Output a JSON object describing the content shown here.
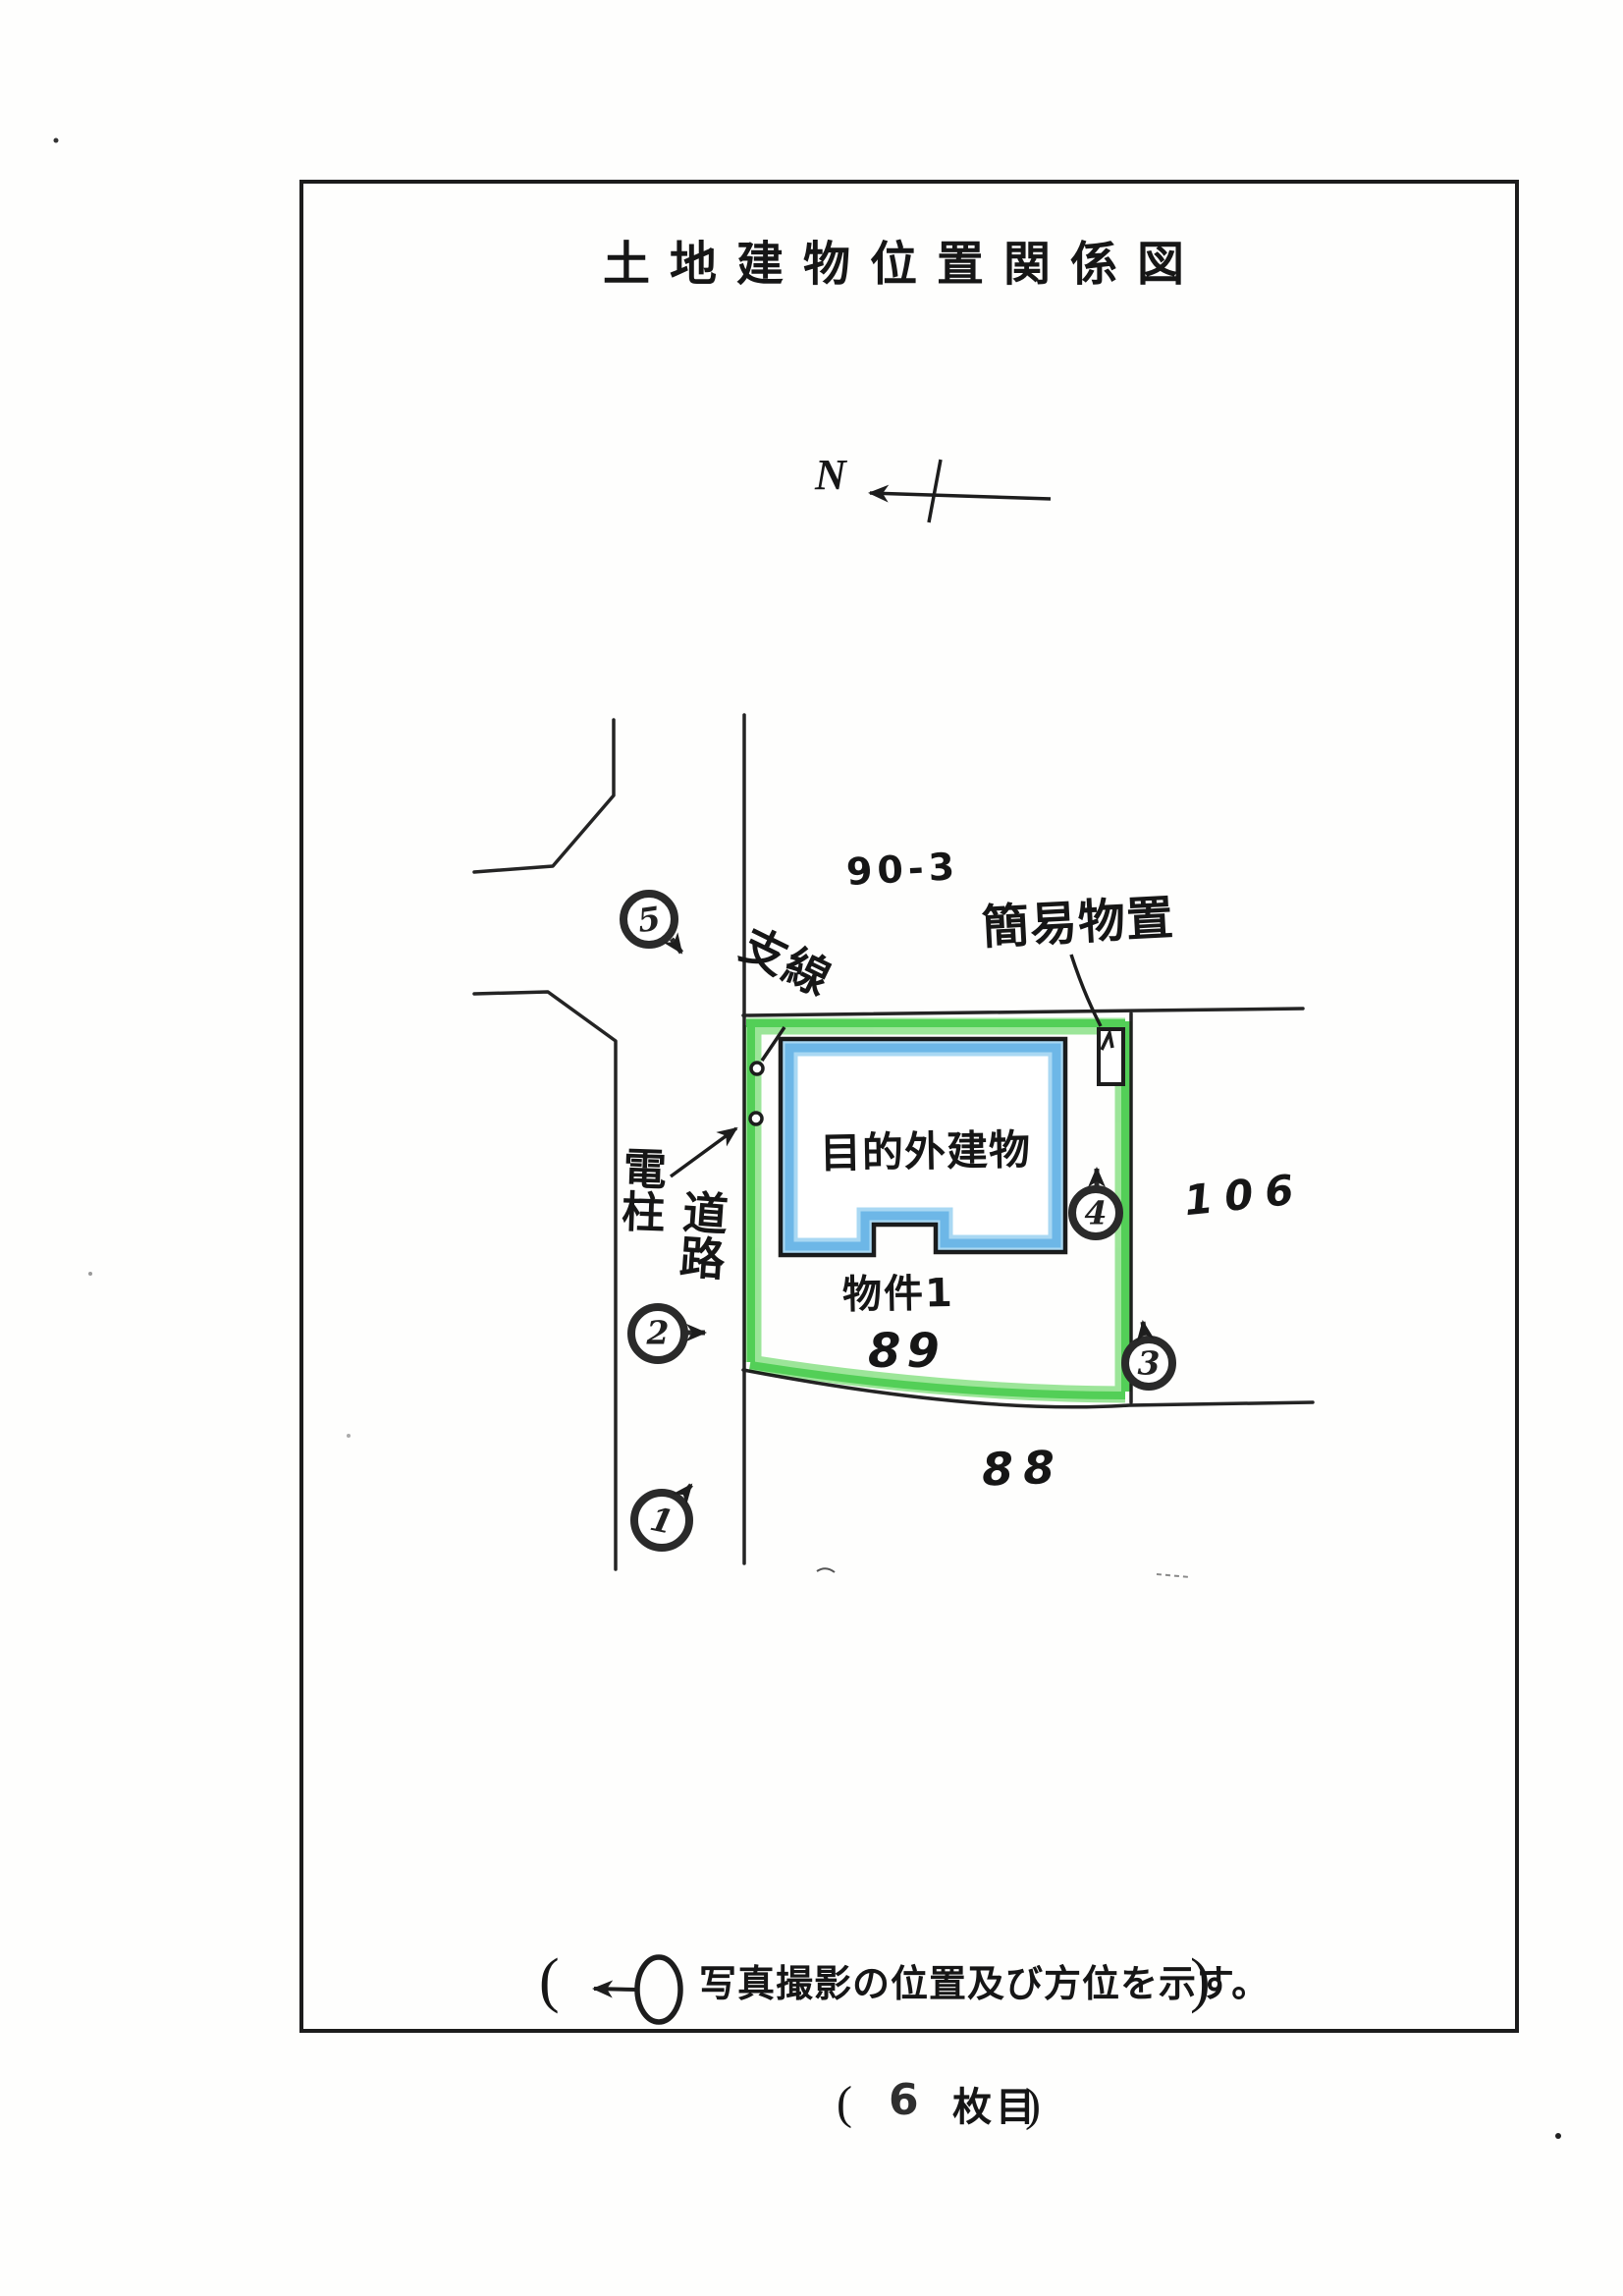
{
  "document": {
    "title": "土地建物位置関係図",
    "compass_label": "N",
    "legend": {
      "open_paren": "(",
      "text": "写真撮影の位置及び方位を示す。",
      "close_paren": ")"
    },
    "footer": {
      "open_paren": "(",
      "page_number": "6",
      "suffix": "枚目",
      "close_paren": ")"
    }
  },
  "map": {
    "lot_numbers": {
      "north_lot": "90-3",
      "property_lot": "89",
      "south_lot": "88",
      "east_lot": "106"
    },
    "labels": {
      "guy_wire": "支線",
      "shed": "簡易物置",
      "offsite_building": "目的外建物",
      "utility_pole": "電柱",
      "road": "道路",
      "property_name": "物件1"
    },
    "photo_markers": [
      {
        "number": "1"
      },
      {
        "number": "2"
      },
      {
        "number": "3"
      },
      {
        "number": "4"
      },
      {
        "number": "5"
      }
    ],
    "colors": {
      "boundary_green": "#4ccf50",
      "building_blue": "#6db9e9",
      "ink": "#1d1d1d"
    }
  }
}
